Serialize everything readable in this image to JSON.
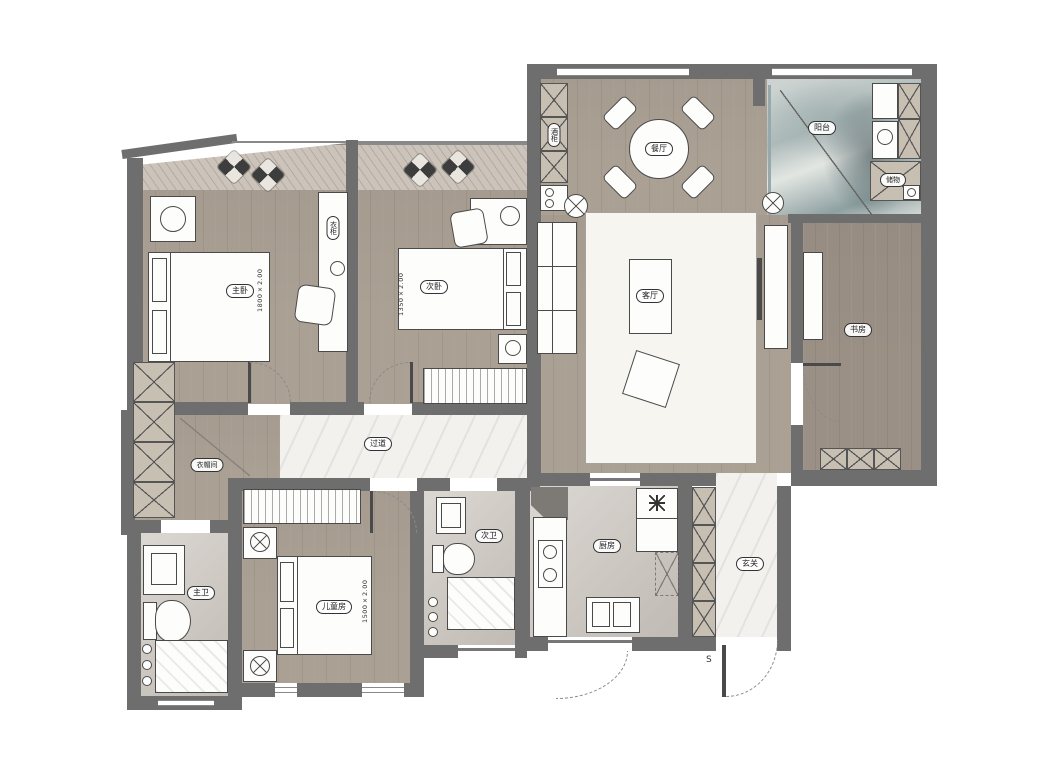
{
  "plan": {
    "rooms": {
      "master_bedroom": {
        "label": "主卧",
        "bed_size": "1800×2.00"
      },
      "second_bedroom": {
        "label": "次卧",
        "bed_size": "1350×2.00"
      },
      "kids_bedroom": {
        "label": "儿童房",
        "bed_size": "1500×2.00"
      },
      "living_room": {
        "label": "客厅"
      },
      "dining_room": {
        "label": "餐厅"
      },
      "kitchen": {
        "label": "厨房"
      },
      "entry": {
        "label": "玄关"
      },
      "balcony": {
        "label": "阳台"
      },
      "study": {
        "label": "书房"
      },
      "hallway": {
        "label": "过道"
      },
      "cloakroom": {
        "label": "衣帽间"
      },
      "master_bath": {
        "label": "主卫"
      },
      "second_bath": {
        "label": "次卫"
      },
      "balcony_storage": {
        "label": "储物"
      },
      "wardrobe": {
        "label": "衣柜"
      },
      "wine_cabinet": {
        "label": "酒柜"
      }
    },
    "marks": {
      "entry_door": "S"
    }
  },
  "colors": {
    "wall": "#6e6e6e",
    "wood_floor": "#aaa094",
    "marble_floor": "#f2f1ee",
    "balcony_wash": "#8ea0a1",
    "furniture": "#fdfdfc"
  }
}
